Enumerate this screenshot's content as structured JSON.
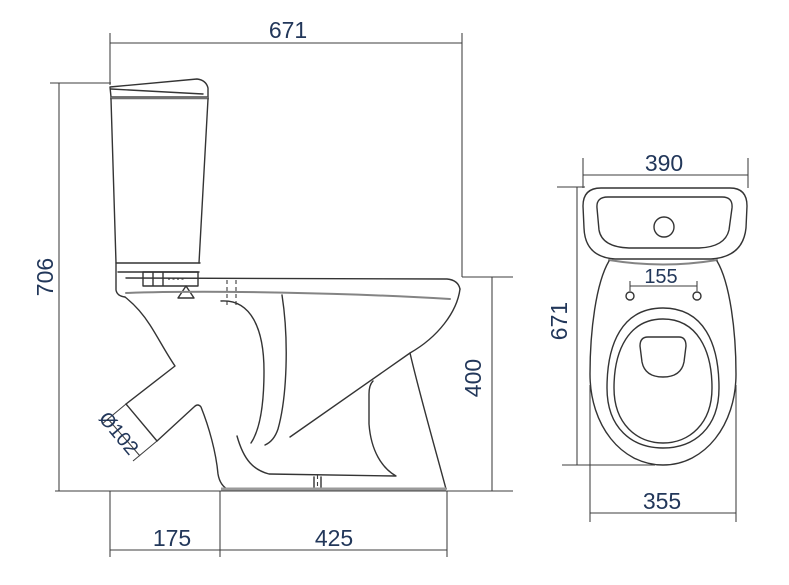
{
  "drawing": {
    "type": "technical-dimension-drawing",
    "subject": "close-coupled toilet (side elevation and plan view)",
    "background_color": "#ffffff",
    "line_color": "#343434",
    "dimension_text_color": "#22375a",
    "side_view": {
      "dims": {
        "overall_depth": "671",
        "overall_height": "706",
        "rim_height": "400",
        "front_offset": "175",
        "base_length": "425",
        "outlet_diameter": "Ø102"
      }
    },
    "top_view": {
      "dims": {
        "cistern_width": "390",
        "seat_bolt_spacing": "155",
        "overall_depth": "671",
        "bowl_width": "355"
      }
    }
  }
}
